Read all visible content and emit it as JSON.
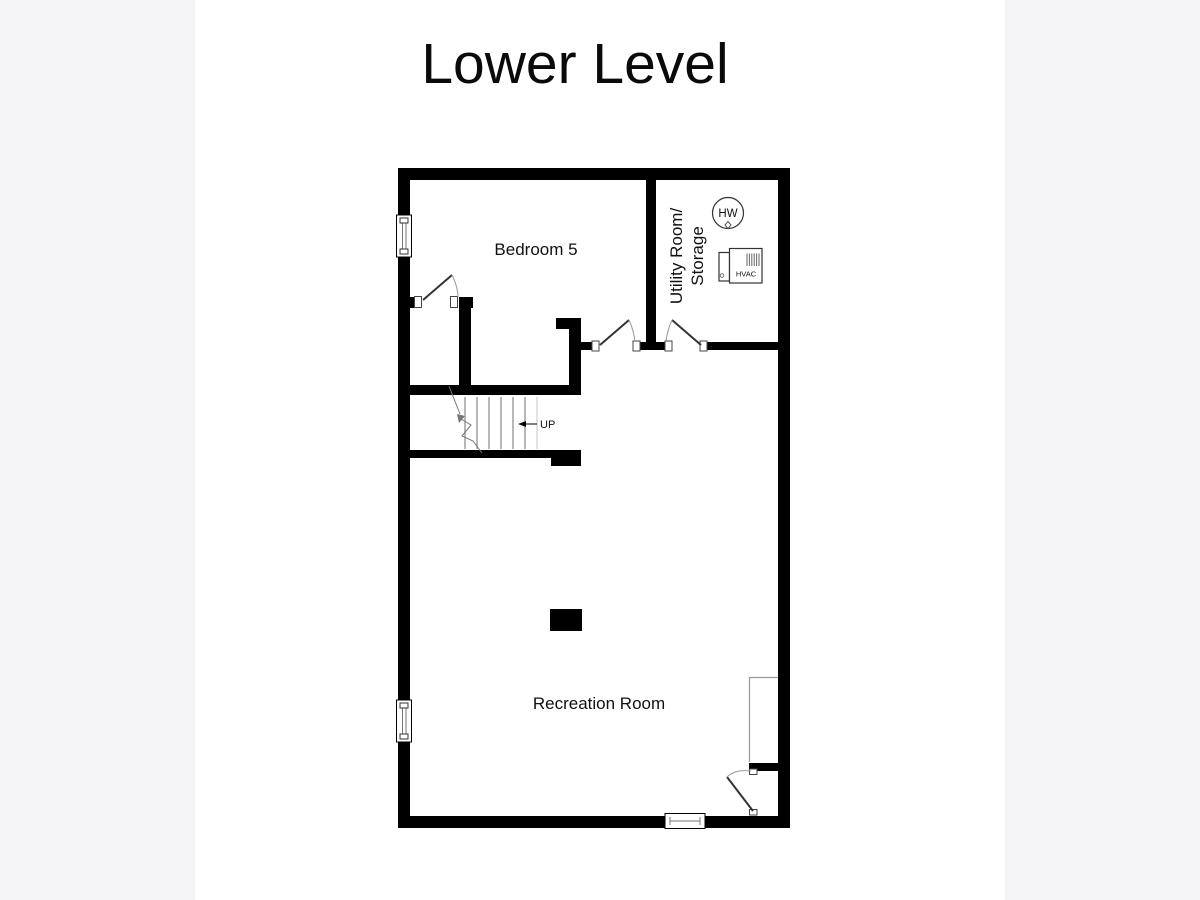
{
  "title": "Lower Level",
  "rooms": [
    {
      "id": "bedroom-5",
      "label": "Bedroom 5"
    },
    {
      "id": "utility-storage",
      "label_line1": "Utility Room/",
      "label_line2": "Storage"
    },
    {
      "id": "recreation-room",
      "label": "Recreation Room"
    }
  ],
  "stairs": {
    "direction_label": "UP"
  },
  "symbols": {
    "water_heater_label": "HW",
    "hvac_label": "HVAC"
  },
  "colors": {
    "matte_background": "#f5f4f6",
    "plan_background": "#ffffff",
    "wall_ink": "#000000"
  }
}
